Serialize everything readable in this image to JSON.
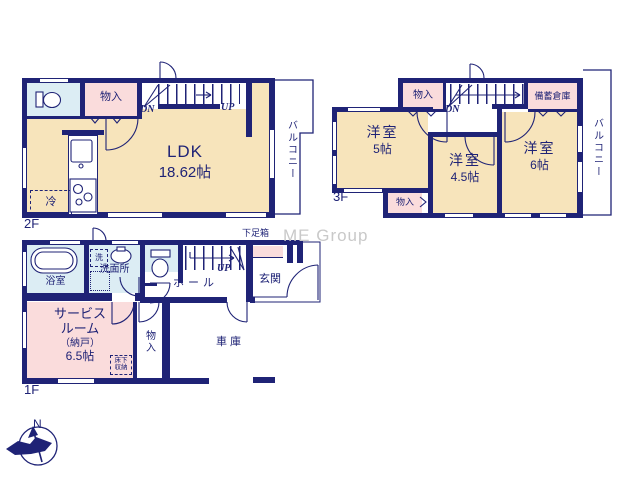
{
  "watermark": "ME Group",
  "colors": {
    "wall": "#1f2376",
    "cream": "#f7e4bb",
    "pink": "#fadcdc",
    "blue": "#dcedf4",
    "watermark": "#c9c9c9"
  },
  "floor2": {
    "label": "2F",
    "ldk_name": "LDK",
    "ldk_size": "18.62帖",
    "closet": "物入",
    "balcony": "バルコニー",
    "fridge": "冷",
    "down": "DN",
    "up": "UP"
  },
  "floor3": {
    "label": "3F",
    "closet_top": "物入",
    "storage": "備蓄倉庫",
    "down": "DN",
    "room5_name": "洋室",
    "room5_size": "5帖",
    "room45_name": "洋室",
    "room45_size": "4.5帖",
    "room6_name": "洋室",
    "room6_size": "6帖",
    "closet_bottom": "物入",
    "balcony": "バルコニー"
  },
  "floor1": {
    "label": "1F",
    "bath": "浴室",
    "laundry": "洗",
    "washroom": "洗面所",
    "hall": "ホール",
    "up": "UP",
    "entrance": "玄関",
    "shoe_box": "下足箱",
    "service_line1": "サービス",
    "service_line2": "ルーム",
    "service_line3": "（納戸）",
    "service_size": "6.5帖",
    "closet": "物入",
    "underfloor_line1": "床下",
    "underfloor_line2": "収納",
    "garage": "車庫"
  },
  "compass": {
    "north": "N"
  }
}
